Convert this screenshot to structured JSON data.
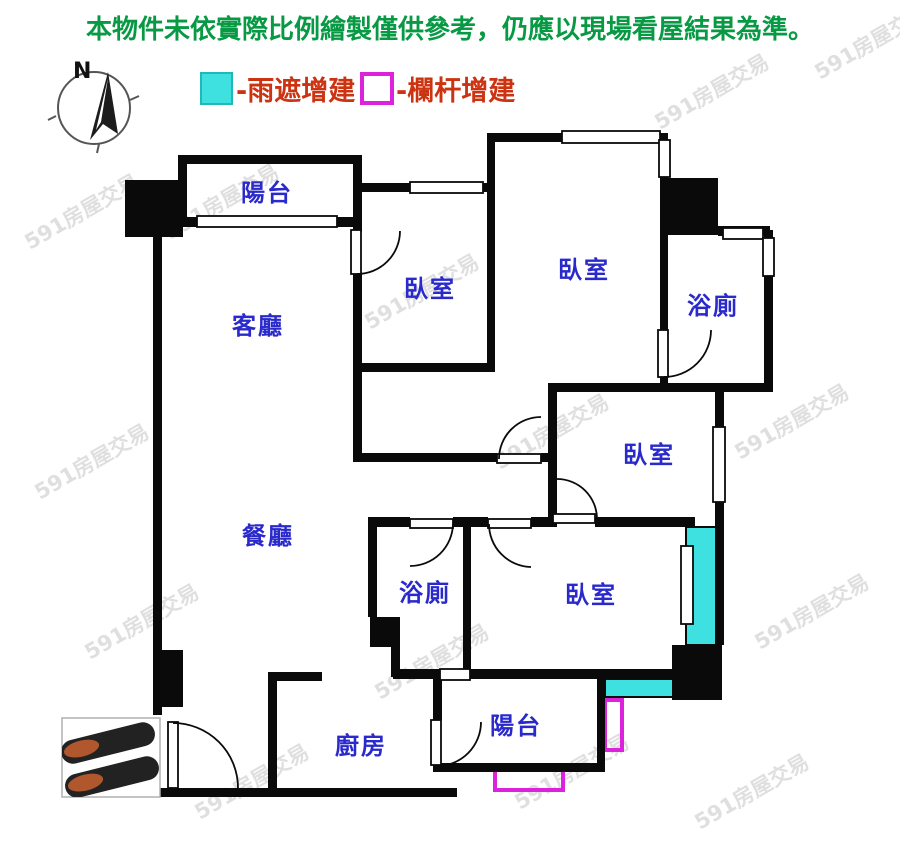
{
  "disclaimer": "本物件未依實際比例繪製僅供參考，仍應以現場看屋結果為準。",
  "legend": {
    "rain_cover_label": "-雨遮增建",
    "railing_label": "-欄杆增建"
  },
  "compass": {
    "north_label": "N"
  },
  "watermark": {
    "text": "591房屋交易"
  },
  "rooms": {
    "balcony_top": "陽台",
    "living": "客廳",
    "bedroom1": "臥室",
    "bedroom2": "臥室",
    "bath1": "浴廁",
    "bedroom3": "臥室",
    "dining": "餐廳",
    "bath2": "浴廁",
    "bedroom4": "臥室",
    "kitchen": "廚房",
    "balcony_bottom": "陽台"
  },
  "colors": {
    "wall": "#0a0a0a",
    "room_label": "#2929cc",
    "disclaimer_green": "#089944",
    "legend_text": "#cc3311",
    "rain_cover_cyan": "#3fe0e0",
    "railing_magenta": "#dd22dd",
    "watermark_gray": "#c6c6c6",
    "shoe_dark": "#222222",
    "shoe_insole": "#b0572e"
  }
}
